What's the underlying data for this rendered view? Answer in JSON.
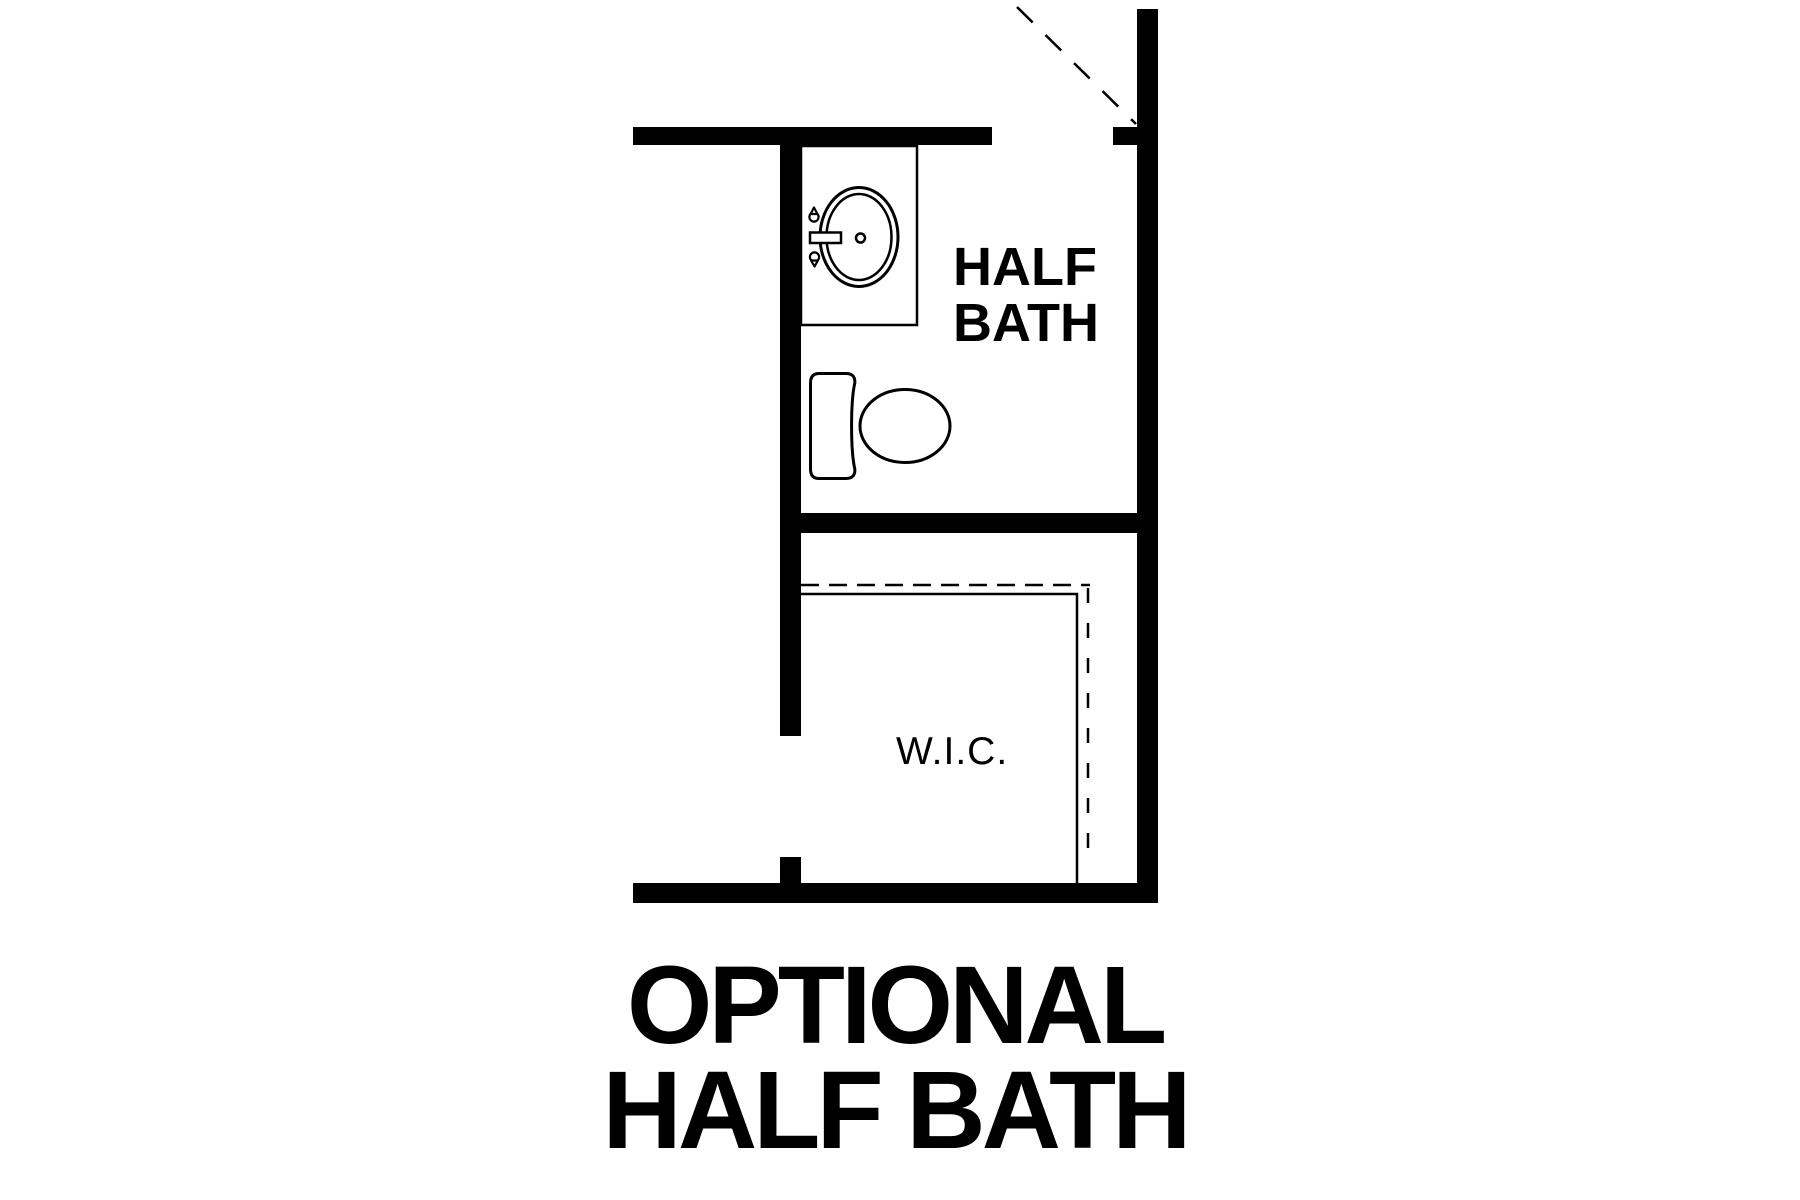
{
  "colors": {
    "ink": "#000000",
    "background": "#ffffff"
  },
  "plan": {
    "type": "floor-plan-option-diagram",
    "rooms": [
      {
        "id": "half-bath",
        "label_line1": "HALF",
        "label_line2": "BATH",
        "fixtures": [
          "sink-vanity",
          "toilet"
        ]
      },
      {
        "id": "walk-in-closet",
        "label": "W.I.C.",
        "features": [
          "shelf-line",
          "closet-rod-dashed-line"
        ]
      }
    ],
    "door": {
      "style": "opening-with-dashed-swing",
      "location": "top-right"
    }
  },
  "title": {
    "line1": "OPTIONAL",
    "line2": "HALF BATH"
  }
}
